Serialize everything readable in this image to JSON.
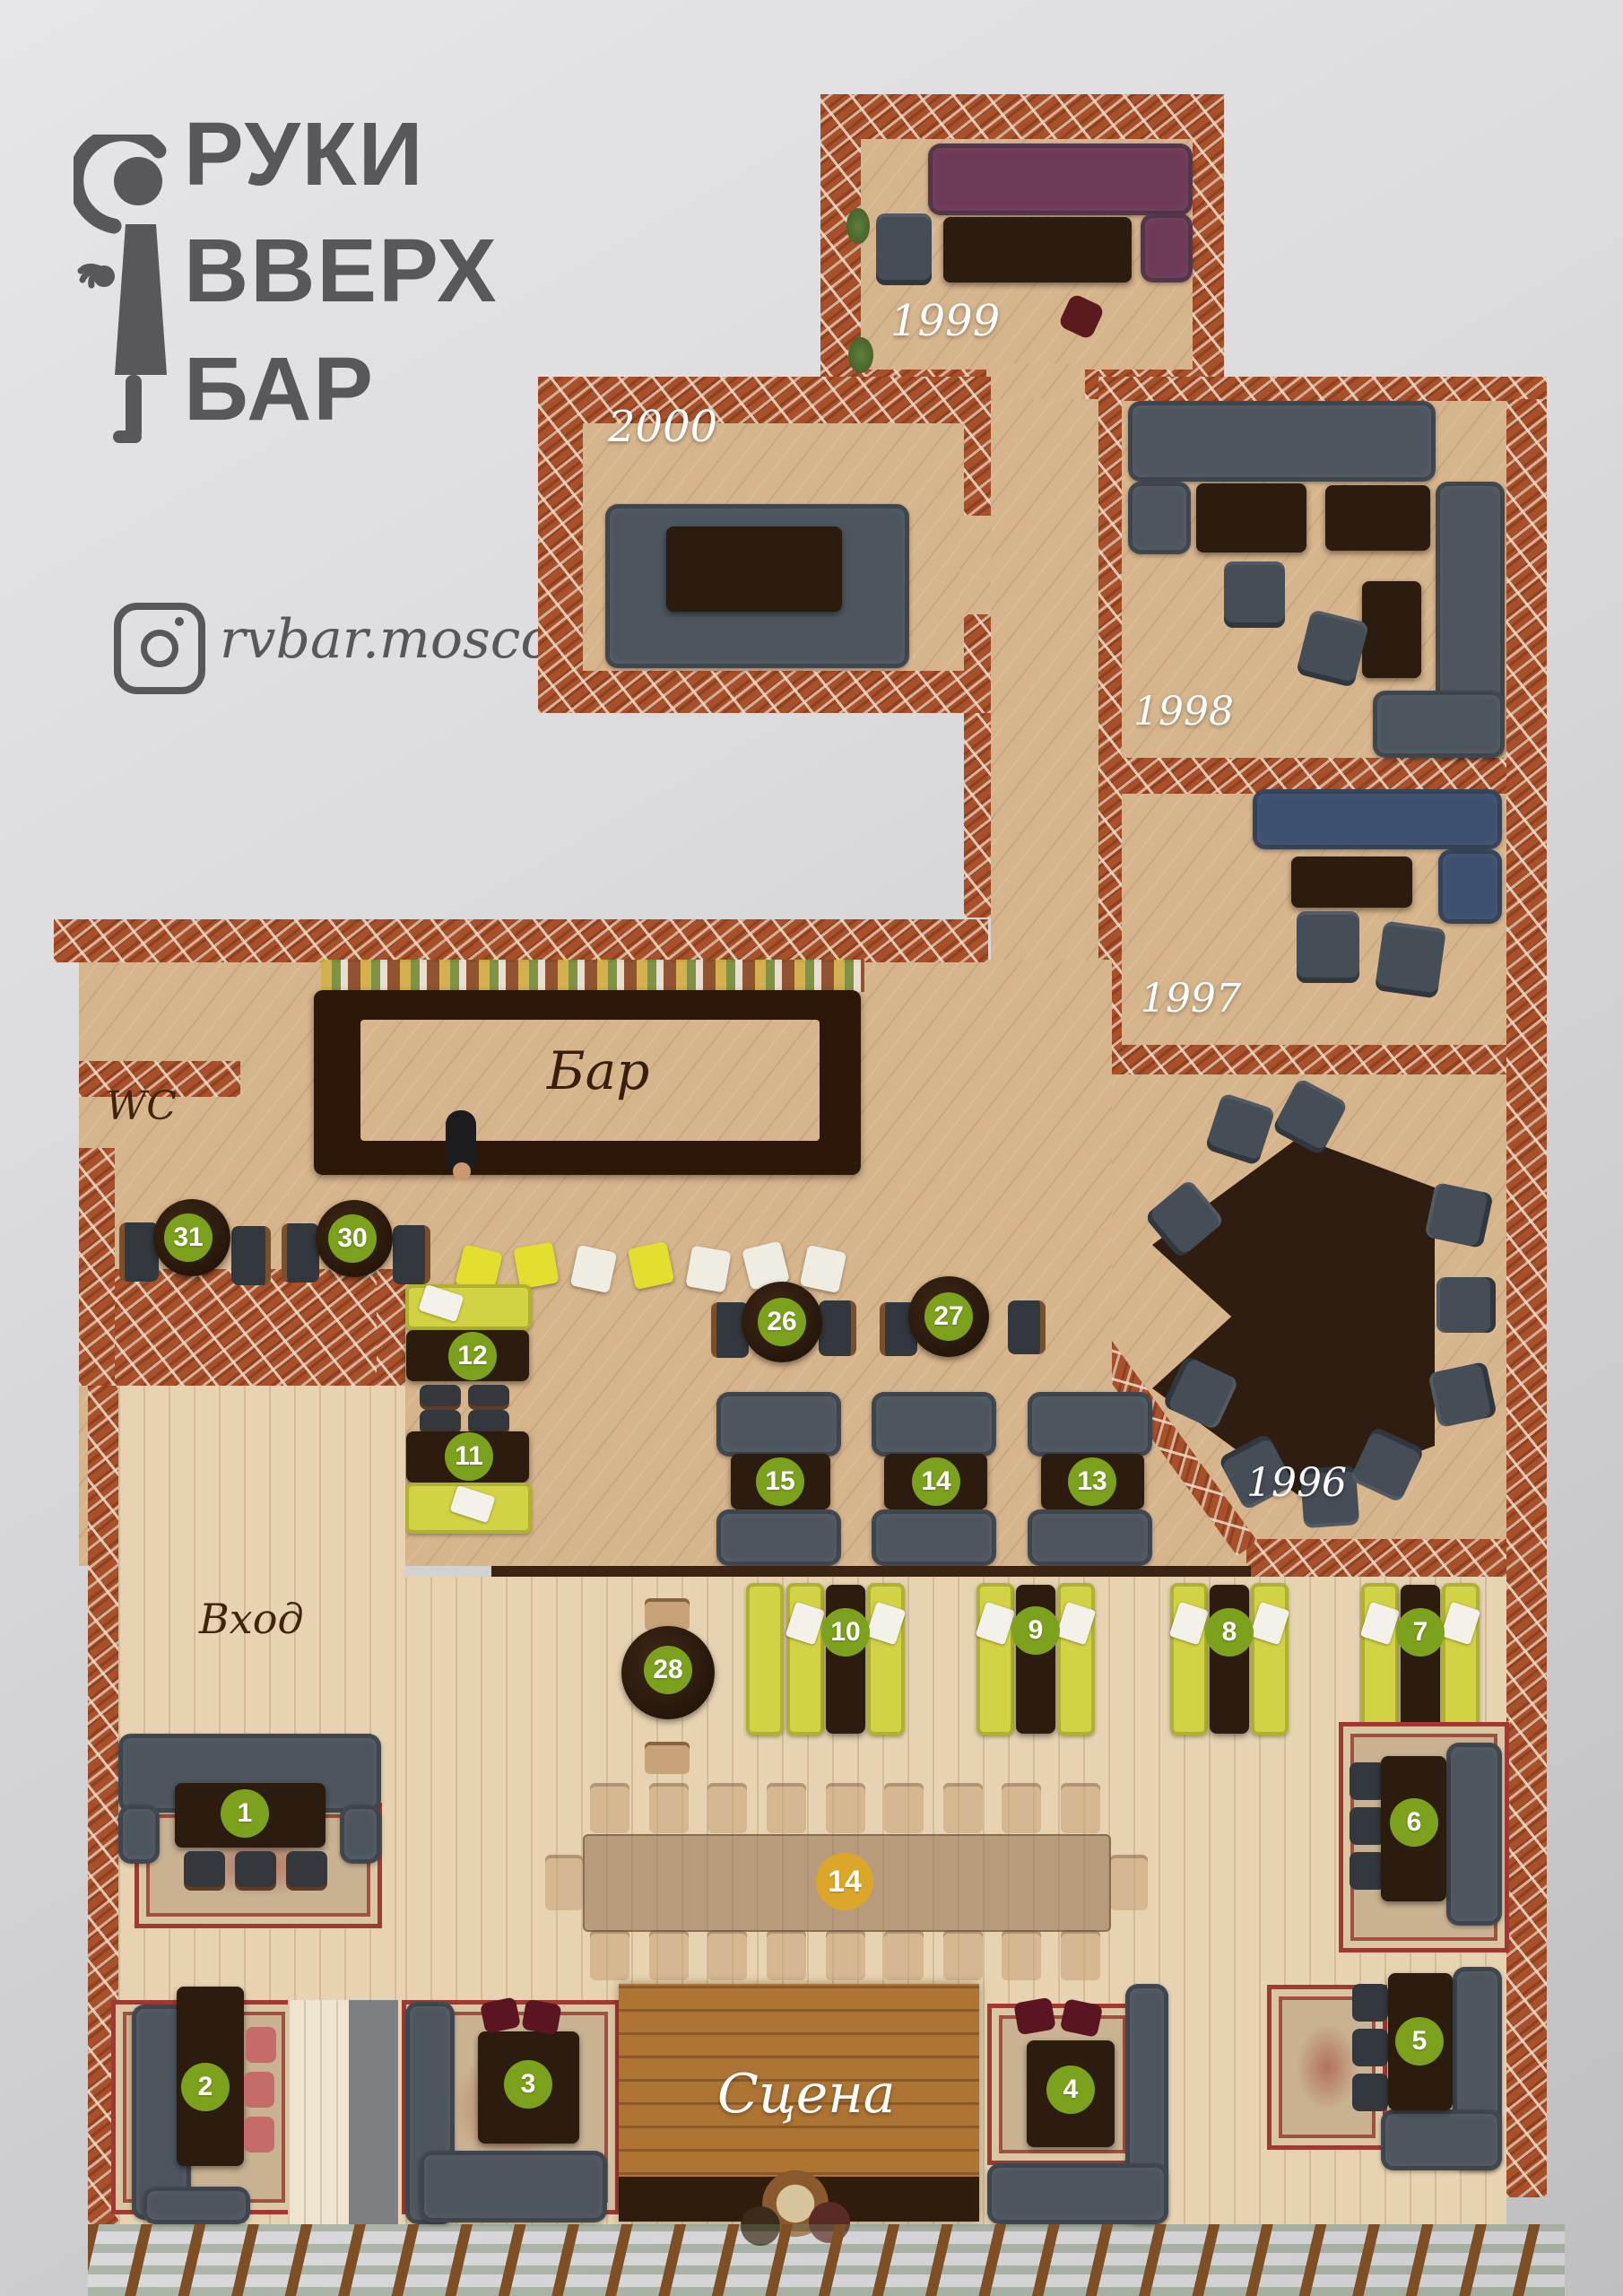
{
  "logo": {
    "line1": "РУКИ",
    "line2": "ВВЕРХ",
    "line3": "БАР",
    "instagram": "rvbar.moscow"
  },
  "labels": {
    "bar": "Бар",
    "wc": "WC",
    "karaoke": "Караоке",
    "entrance": "Вход",
    "stage": "Сцена",
    "room_1996": "1996",
    "room_1997": "1997",
    "room_1998": "1998",
    "room_1999": "1999",
    "room_2000": "2000"
  },
  "badges": {
    "t1": "1",
    "t2": "2",
    "t3": "3",
    "t4": "4",
    "t5": "5",
    "t6": "6",
    "t7": "7",
    "t8": "8",
    "t9": "9",
    "t10": "10",
    "t11": "11",
    "t12": "12",
    "t13": "13",
    "t14": "14",
    "t15": "15",
    "t26": "26",
    "t27": "27",
    "t28": "28",
    "t30": "30",
    "t31": "31",
    "big14": "14"
  },
  "colors": {
    "badge_green": "#7ca11d",
    "badge_orange": "#dca728",
    "brick": "#a8502a",
    "floor_wood": "#d6b48c",
    "floor_pale": "#e7d3b1",
    "sofa_gray": "#4d555e",
    "sofa_yellow": "#d2d245",
    "sofa_purple": "#6e3a58",
    "sofa_blue": "#3d5070",
    "logo_gray": "#58585a"
  }
}
